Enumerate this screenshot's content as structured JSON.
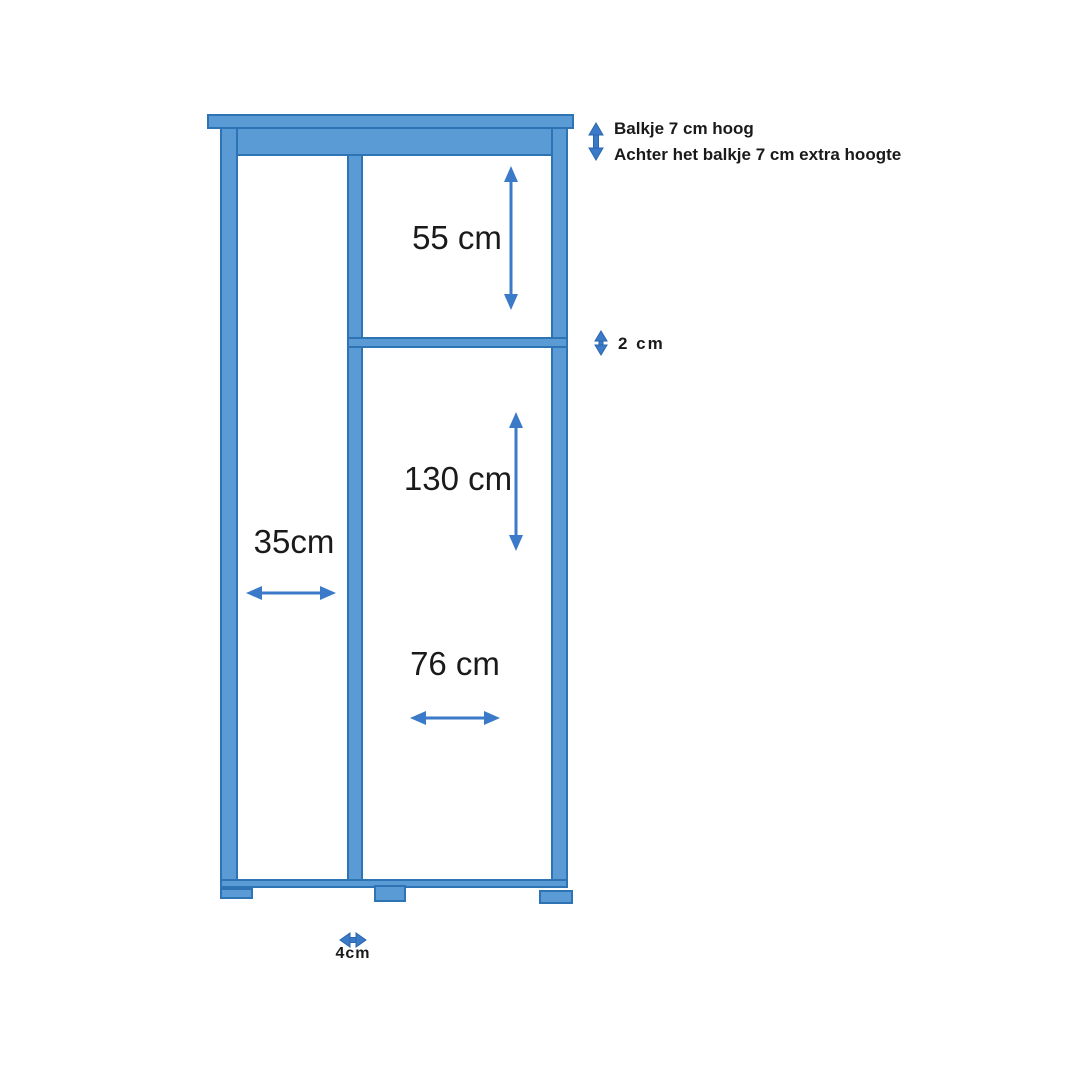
{
  "page": {
    "background": "#ffffff"
  },
  "diagram": {
    "colors": {
      "fill": "#5B9BD5",
      "border": "#2E74B5",
      "arrow": "#3A7AC8",
      "arrow_dark": "#2B66AC",
      "text": "#1a1a1a"
    },
    "notes": {
      "line1": "Balkje 7 cm hoog",
      "line2": "Achter het balkje 7 cm extra hoogte"
    },
    "dimensions": {
      "top_compartment_height": "55 cm",
      "shelf_thickness": "2 cm",
      "lower_compartment_height": "130 cm",
      "left_compartment_width": "35cm",
      "right_compartment_width": "76 cm",
      "foot_width": "4cm"
    }
  }
}
